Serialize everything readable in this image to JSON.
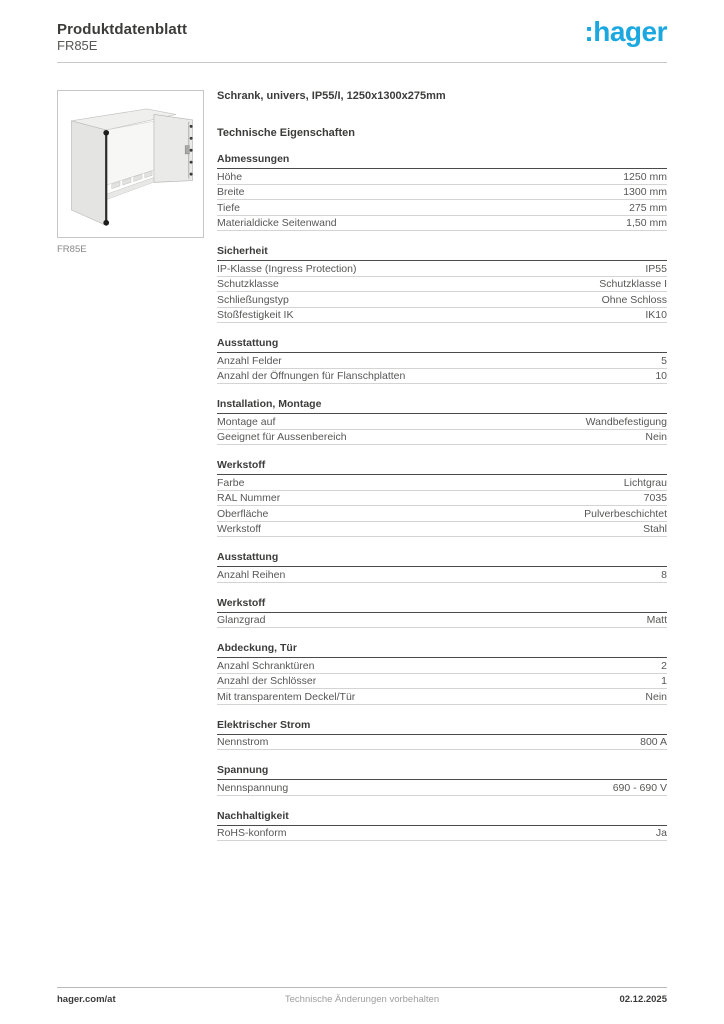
{
  "brand": {
    "logo_text": ":hager",
    "logo_color": "#1BA8E0"
  },
  "header": {
    "title": "Produktdatenblatt",
    "subtitle": "FR85E"
  },
  "product": {
    "image_caption": "FR85E",
    "title": "Schrank, univers, IP55/I, 1250x1300x275mm",
    "tech_heading": "Technische Eigenschaften"
  },
  "sections": [
    {
      "title": "Abmessungen",
      "rows": [
        {
          "label": "Höhe",
          "value": "1250 mm"
        },
        {
          "label": "Breite",
          "value": "1300 mm"
        },
        {
          "label": "Tiefe",
          "value": "275 mm"
        },
        {
          "label": "Materialdicke Seitenwand",
          "value": "1,50 mm"
        }
      ]
    },
    {
      "title": "Sicherheit",
      "rows": [
        {
          "label": "IP-Klasse (Ingress Protection)",
          "value": "IP55"
        },
        {
          "label": "Schutzklasse",
          "value": "Schutzklasse I"
        },
        {
          "label": "Schließungstyp",
          "value": "Ohne Schloss"
        },
        {
          "label": "Stoßfestigkeit IK",
          "value": "IK10"
        }
      ]
    },
    {
      "title": "Ausstattung",
      "rows": [
        {
          "label": "Anzahl Felder",
          "value": "5"
        },
        {
          "label": "Anzahl der Öffnungen für Flanschplatten",
          "value": "10"
        }
      ]
    },
    {
      "title": "Installation, Montage",
      "rows": [
        {
          "label": "Montage auf",
          "value": "Wandbefestigung"
        },
        {
          "label": "Geeignet für Aussenbereich",
          "value": "Nein"
        }
      ]
    },
    {
      "title": "Werkstoff",
      "rows": [
        {
          "label": "Farbe",
          "value": "Lichtgrau"
        },
        {
          "label": "RAL Nummer",
          "value": "7035"
        },
        {
          "label": "Oberfläche",
          "value": "Pulverbeschichtet"
        },
        {
          "label": "Werkstoff",
          "value": "Stahl"
        }
      ]
    },
    {
      "title": "Ausstattung",
      "rows": [
        {
          "label": "Anzahl Reihen",
          "value": "8"
        }
      ]
    },
    {
      "title": "Werkstoff",
      "rows": [
        {
          "label": "Glanzgrad",
          "value": "Matt"
        }
      ]
    },
    {
      "title": "Abdeckung, Tür",
      "rows": [
        {
          "label": "Anzahl Schranktüren",
          "value": "2"
        },
        {
          "label": "Anzahl der Schlösser",
          "value": "1"
        },
        {
          "label": "Mit transparentem Deckel/Tür",
          "value": "Nein"
        }
      ]
    },
    {
      "title": "Elektrischer Strom",
      "rows": [
        {
          "label": "Nennstrom",
          "value": "800 A"
        }
      ]
    },
    {
      "title": "Spannung",
      "rows": [
        {
          "label": "Nennspannung",
          "value": "690 - 690 V"
        }
      ]
    },
    {
      "title": "Nachhaltigkeit",
      "rows": [
        {
          "label": "RoHS-konform",
          "value": "Ja"
        }
      ]
    }
  ],
  "footer": {
    "left": "hager.com/at",
    "center": "Technische Änderungen vorbehalten",
    "right": "02.12.2025"
  }
}
